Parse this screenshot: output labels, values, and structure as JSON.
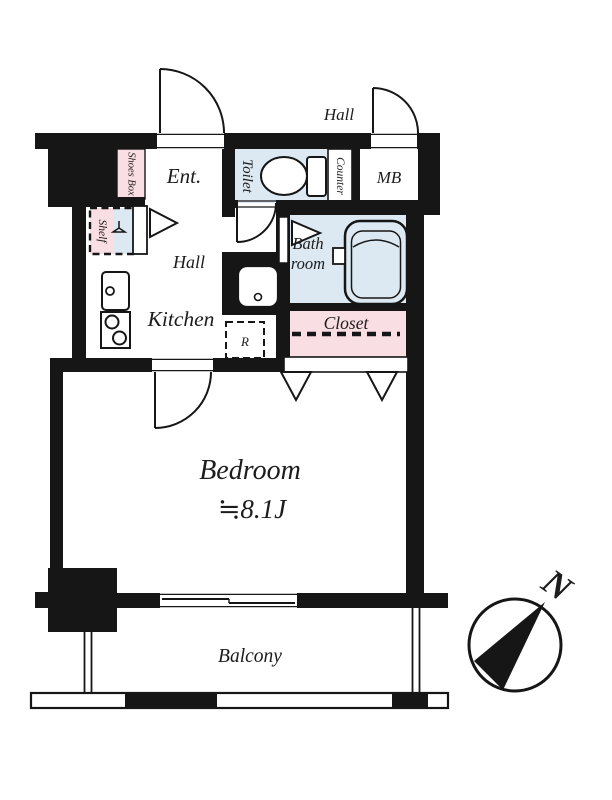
{
  "floorplan": {
    "labels": {
      "hall_upper": "Hall",
      "entrance": "Ent.",
      "shoes_box": "Shoes Box",
      "toilet": "Toilet",
      "counter": "Counter",
      "meter_box": "MB",
      "shelf": "Shelf",
      "hall_inner": "Hall",
      "kitchen": "Kitchen",
      "bath_line1": "Bath",
      "bath_line2": "room",
      "closet": "Closet",
      "refrigerator": "R",
      "bedroom": "Bedroom",
      "bedroom_size": "≒8.1J",
      "balcony": "Balcony",
      "north": "N"
    },
    "colors": {
      "wall": "#161616",
      "wet_area": "#dce9f2",
      "storage_pink": "#f9dee3",
      "outline": "#1c1c1c",
      "background": "#ffffff"
    }
  }
}
